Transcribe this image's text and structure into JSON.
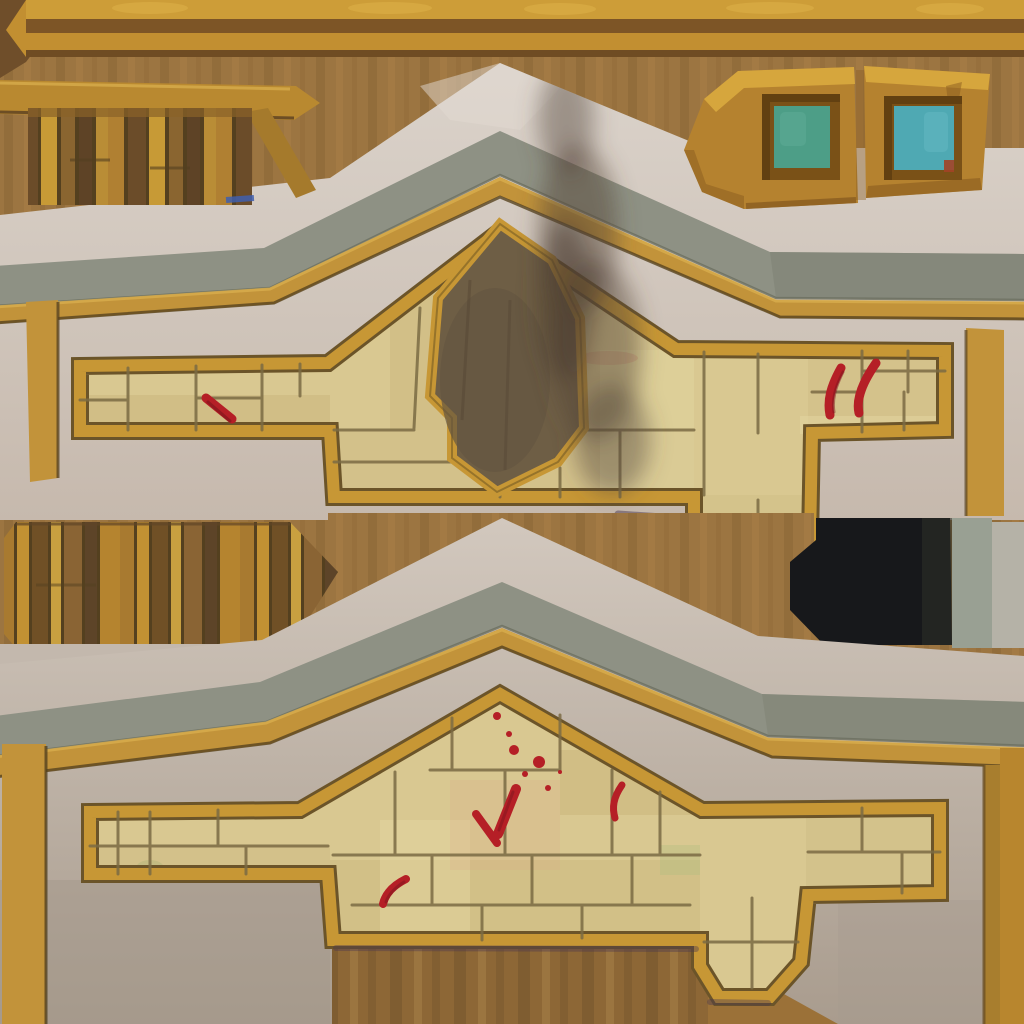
{
  "meta": {
    "kind": "game-texture-atlas",
    "subject": "hand-painted stylized building facade texture sheet (two gabled stone wall pieces, wooden beams and planks, shuttered teal windows, burn mark, red paint splatters, black panel)",
    "width_px": 1024,
    "height_px": 1024
  },
  "palette": {
    "bg-wood": "#9c7541",
    "bg-stripe-dark": "#8b6636",
    "bg-stripe-light": "#a97f48",
    "corner-dark": "#6f4e2a",
    "beam-gold-bright": "#cd9d38",
    "beam-dark": "#7d5526",
    "beam-gold": "#c28f31",
    "beam-edge": "#6f4c23",
    "beam-highlight": "#e0b449",
    "rail-gold": "#b98930",
    "rail-gold-dark": "#a57a2c",
    "rail-edge": "#6d4e24",
    "plank-1": "#b08032",
    "plank-2": "#6b4c29",
    "plank-3": "#c79a36",
    "plank-4": "#8a6530",
    "plank-5": "#5e4326",
    "plank-6": "#b98d36",
    "plank-sep": "#54401f",
    "plankb-1": "#a87a30",
    "plankb-2": "#c29133",
    "plankb-3": "#705026",
    "plankb-4": "#c9a040",
    "plankb-5": "#8a6434",
    "plankb-6": "#5d4428",
    "plankb-7": "#b5842f",
    "window-frame": "#b5822f",
    "window-frame-hi": "#d8a83e",
    "window-frame-dark": "#8a5c20",
    "window-recess": "#7a5117",
    "window-teal-left": "#4d9e87",
    "window-teal-left-hi": "#5aa893",
    "window-teal-right": "#4fa9b3",
    "window-teal-right-hi": "#63b7c0",
    "window-red-sliver": "#a34326",
    "plaster-hi": "#dbd3cb",
    "plaster-lo": "#c6b9ad",
    "plaster-mid": "#c3b8ad",
    "lower-plaster-hi": "#d2c8be",
    "lower-plaster-lo": "#a99c8e",
    "cap-gray": "#8e9184",
    "cap-gray-dark": "#7c8071",
    "trim-gold": "#c2933a",
    "trim-gold-hi": "#dcb050",
    "trim-gold-edge": "#57441f",
    "gold-bright": "#b8862e",
    "gold-deep": "#a87e2e",
    "frame-gold": "#c79735",
    "frame-dark": "#6b5429",
    "stone-light": "#d9c891",
    "stone-mid": "#cfbd86",
    "stone-dark": "#c3ad72",
    "stone-pale": "#e3d6a2",
    "stone-line": "#7b6b44",
    "stone-pink": "#d9a98a",
    "stone-green": "#aebd7d",
    "burn-fill": "#6e5e45",
    "burn-dark": "#645542",
    "smoke": "#55453a",
    "blood": "#b51f26",
    "blood-dark": "#7d161d",
    "blood-smear": "#cf8872",
    "shadow-purple": "#4a3850",
    "black-box": "#17181b",
    "black-box-hi": "#2c2f28",
    "gray-band-a": "#99a093",
    "gray-band-b": "#b5b2a7",
    "under-wood": "#8d6736",
    "under-wood-dark": "#7c5a2f",
    "under-wood-light": "#9b7540",
    "flat-brown": "#9b7138",
    "blue-dash": "#3f5fae"
  },
  "regions": [
    {
      "id": "top-wooden-beam",
      "interactable": false
    },
    {
      "id": "upper-left-plank-fence",
      "interactable": false
    },
    {
      "id": "wooden-rail",
      "interactable": false
    },
    {
      "id": "window-panel-left",
      "interactable": false
    },
    {
      "id": "window-panel-right",
      "interactable": false
    },
    {
      "id": "upper-wall-piece",
      "interactable": false
    },
    {
      "id": "gable-burn-shield",
      "interactable": false
    },
    {
      "id": "smoke-stain",
      "interactable": false
    },
    {
      "id": "upper-red-paint-marks",
      "interactable": false
    },
    {
      "id": "mid-left-plank-strip",
      "interactable": false
    },
    {
      "id": "black-panel",
      "interactable": false
    },
    {
      "id": "lower-wall-piece",
      "interactable": false
    },
    {
      "id": "lower-blood-splatters",
      "interactable": false
    },
    {
      "id": "background-wood",
      "interactable": false
    }
  ]
}
